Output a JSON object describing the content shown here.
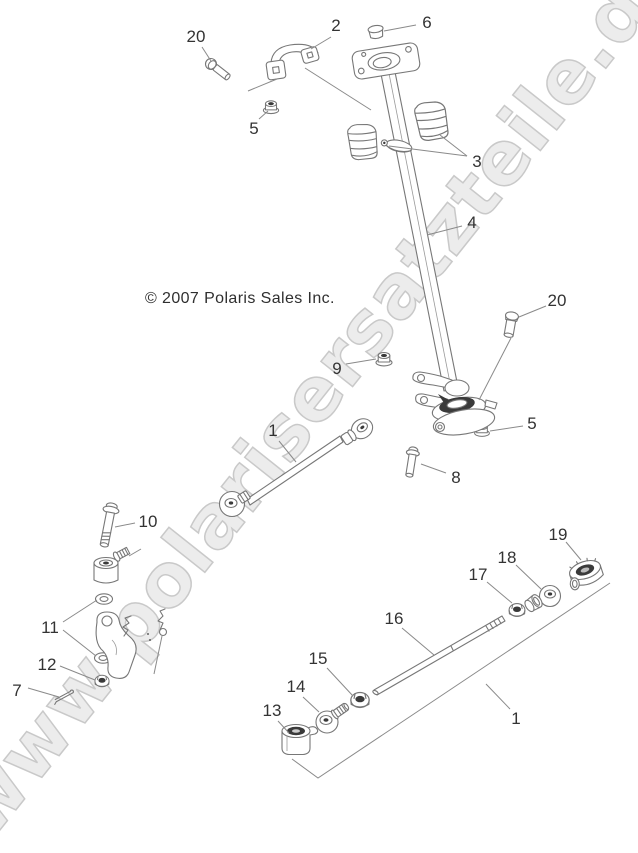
{
  "figure": {
    "copyright": "© 2007 Polaris Sales Inc.",
    "watermark": "www.polarisersatzteile.de"
  },
  "colors": {
    "line": "#777777",
    "leader": "#8a8a8a",
    "label": "#333333",
    "watermark_fill": "#ececec",
    "watermark_outline": "#c9c9c9",
    "background": "#ffffff"
  },
  "callouts": [
    {
      "label": "20",
      "x": 196,
      "y": 36,
      "leaders": [
        [
          [
            202,
            47
          ],
          [
            211,
            61
          ]
        ]
      ]
    },
    {
      "label": "2",
      "x": 336,
      "y": 25,
      "leaders": [
        [
          [
            331,
            37
          ],
          [
            311,
            49
          ]
        ]
      ]
    },
    {
      "label": "6",
      "x": 427,
      "y": 22,
      "leaders": [
        [
          [
            416,
            25
          ],
          [
            384,
            31
          ]
        ]
      ]
    },
    {
      "label": "5",
      "x": 254,
      "y": 128,
      "leaders": [
        [
          [
            259,
            119
          ],
          [
            268,
            111
          ]
        ]
      ]
    },
    {
      "label": "3",
      "x": 477,
      "y": 161,
      "leaders": [
        [
          [
            467,
            156
          ],
          [
            389,
            146
          ]
        ],
        [
          [
            467,
            156
          ],
          [
            440,
            135
          ]
        ]
      ]
    },
    {
      "label": "4",
      "x": 472,
      "y": 222,
      "leaders": [
        [
          [
            462,
            226
          ],
          [
            427,
            235
          ]
        ]
      ]
    },
    {
      "label": "9",
      "x": 337,
      "y": 368,
      "leaders": [
        [
          [
            346,
            364
          ],
          [
            376,
            359
          ]
        ]
      ]
    },
    {
      "label": "20",
      "x": 557,
      "y": 300,
      "leaders": [
        [
          [
            546,
            306
          ],
          [
            519,
            317
          ]
        ]
      ]
    },
    {
      "label": "5",
      "x": 532,
      "y": 423,
      "leaders": [
        [
          [
            523,
            426
          ],
          [
            490,
            431
          ]
        ]
      ]
    },
    {
      "label": "8",
      "x": 456,
      "y": 477,
      "leaders": [
        [
          [
            446,
            473
          ],
          [
            421,
            464
          ]
        ]
      ]
    },
    {
      "label": "1",
      "x": 273,
      "y": 430,
      "leaders": [
        [
          [
            279,
            441
          ],
          [
            296,
            462
          ]
        ]
      ]
    },
    {
      "label": "10",
      "x": 148,
      "y": 521,
      "leaders": [
        [
          [
            135,
            523
          ],
          [
            115,
            527
          ]
        ]
      ]
    },
    {
      "label": "11",
      "x": 50,
      "y": 627,
      "leaders": [
        [
          [
            63,
            622
          ],
          [
            97,
            600
          ]
        ],
        [
          [
            63,
            630
          ],
          [
            96,
            656
          ]
        ]
      ]
    },
    {
      "label": "12",
      "x": 47,
      "y": 664,
      "leaders": [
        [
          [
            60,
            666
          ],
          [
            95,
            680
          ]
        ]
      ]
    },
    {
      "label": "7",
      "x": 17,
      "y": 690,
      "leaders": [
        [
          [
            28,
            688
          ],
          [
            59,
            697
          ]
        ]
      ]
    },
    {
      "label": "13",
      "x": 272,
      "y": 710,
      "leaders": [
        [
          [
            278,
            721
          ],
          [
            289,
            733
          ]
        ]
      ]
    },
    {
      "label": "14",
      "x": 296,
      "y": 686,
      "leaders": [
        [
          [
            303,
            697
          ],
          [
            319,
            712
          ]
        ]
      ]
    },
    {
      "label": "15",
      "x": 318,
      "y": 658,
      "leaders": [
        [
          [
            327,
            668
          ],
          [
            353,
            696
          ]
        ]
      ]
    },
    {
      "label": "16",
      "x": 394,
      "y": 618,
      "leaders": [
        [
          [
            402,
            628
          ],
          [
            434,
            655
          ]
        ]
      ]
    },
    {
      "label": "17",
      "x": 478,
      "y": 574,
      "leaders": [
        [
          [
            487,
            582
          ],
          [
            512,
            603
          ]
        ]
      ]
    },
    {
      "label": "18",
      "x": 507,
      "y": 557,
      "leaders": [
        [
          [
            516,
            565
          ],
          [
            541,
            589
          ]
        ]
      ]
    },
    {
      "label": "19",
      "x": 558,
      "y": 534,
      "leaders": [
        [
          [
            566,
            542
          ],
          [
            581,
            560
          ]
        ]
      ]
    },
    {
      "label": "1",
      "x": 516,
      "y": 718,
      "leaders": [
        [
          [
            510,
            709
          ],
          [
            486,
            684
          ]
        ]
      ]
    }
  ],
  "context_lines": [
    {
      "name": "clamp-to-column-line",
      "points": [
        [
          305,
          68
        ],
        [
          371,
          110
        ]
      ]
    },
    {
      "name": "clamp-tab-line",
      "points": [
        [
          277,
          79
        ],
        [
          248,
          91
        ]
      ]
    },
    {
      "name": "bolt20-to-mount-line",
      "points": [
        [
          511,
          338
        ],
        [
          479,
          400
        ]
      ]
    },
    {
      "name": "assembly-bracket-line",
      "points": [
        [
          610,
          583
        ],
        [
          318,
          778
        ],
        [
          292,
          759
        ]
      ]
    },
    {
      "name": "rod-end-stud-line",
      "points": [
        [
          129,
          556
        ],
        [
          141,
          549
        ]
      ]
    },
    {
      "name": "attachment-mark-line",
      "points": [
        [
          162,
          636
        ],
        [
          154,
          674
        ]
      ]
    }
  ]
}
